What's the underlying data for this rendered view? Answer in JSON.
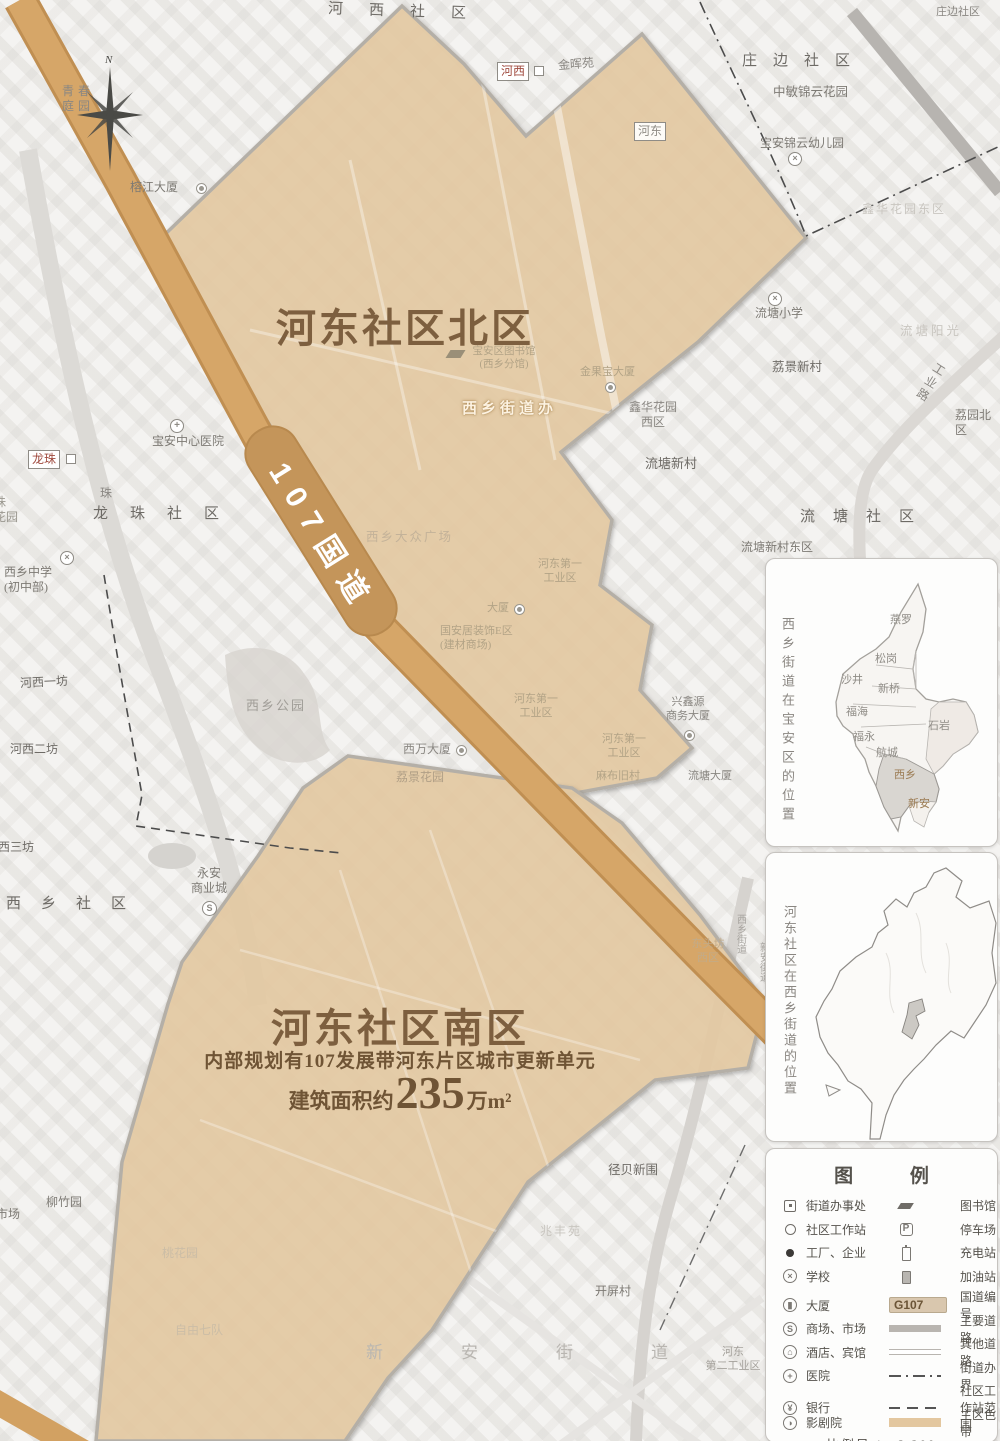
{
  "map": {
    "road_badge": "107国道",
    "compass_n": "N",
    "region_north": {
      "title": "河东社区北区"
    },
    "region_south": {
      "title": "河东社区南区",
      "subtitle": "内部规划有107发展带河东片区城市更新单元",
      "area_prefix": "建筑面积约",
      "area_value": "235",
      "area_suffix": "万m²"
    },
    "colors": {
      "zone_fill": "#e6cba4",
      "road_107": "#d2a162",
      "title_brown": "#7d5f3f"
    },
    "labels": {
      "hexi_shequ": "河西社区",
      "hexi_box": "河西",
      "jinhuiyuan": "金晖苑",
      "zhuangbian": "庄边社区",
      "zhuangbian_corner": "庄边社区",
      "zhongmin": "中敏锦云花园",
      "baoan_kg": "宝安锦云幼儿园",
      "hedong_box": "河东",
      "xinhua_east": "鑫华花园东区",
      "qingchun": "青春\n庭园",
      "rongjiang": "榕江大厦",
      "longzhu_box": "龙珠",
      "hospital": "宝安中心医院",
      "longzhu_shequ": "龙珠社区",
      "zhu_char": "珠",
      "longzhu_garden": "珠\n花园",
      "xixiang_middle": "西乡中学\n(初中部)",
      "hexi_yifang": "河西一坊",
      "hexi_erfang": "河西二坊",
      "hexi_sanfang": "西三坊",
      "xixiang_shequ": "西乡社区",
      "xixiang_park": "西乡公园",
      "yongan": "永安\n商业城",
      "lijing_garden": "荔景花园",
      "ximan_dasha": "西万大厦",
      "jiedaoban": "西乡街道办",
      "library": "宝安区图书馆\n(西乡分馆)",
      "jinguobao": "金果宝大厦",
      "plaza": "西乡大众广场",
      "hedong1a": "河东第一\n工业区",
      "dasha": "大厦",
      "guoanju": "国安居装饰E区\n(建材商场)",
      "hedong1b": "河东第一\n工业区",
      "hedong1c": "河东第一\n工业区",
      "xingxinyuan": "兴鑫源\n商务大厦",
      "mabu": "麻布旧村",
      "liutang_dasha": "流塘大厦",
      "liutang_school": "流塘小学",
      "liutang_sun": "流塘阳光",
      "lijing_xincun": "荔景新村",
      "gongye_road": "工业路",
      "liyuan_north": "荔园北区",
      "liutang_xincun": "流塘新村",
      "liutang_shequ": "流塘社区",
      "liutang_east": "流塘新村东区",
      "xinhua_west": "鑫华花园\n西区",
      "liuzhuyuan": "柳竹园",
      "shichang": "市场",
      "jingbei": "径贝新围",
      "zhaofeng": "兆丰苑",
      "kaiping": "开屏村",
      "xinan_jiedao": "新安街道",
      "hedong2": "河东\n第二工业区",
      "taohuayuan": "桃花园",
      "ziyou": "自由七队",
      "dongtou_west": "东头坊\n西区",
      "xixiang_jiedao_v": "西乡街道",
      "xinan_jiedao_v": "新安街道"
    }
  },
  "insets": {
    "baoan": {
      "title": "西乡街道在宝安区的位置",
      "districts": [
        "燕罗",
        "松岗",
        "沙井",
        "新桥",
        "福海",
        "石岩",
        "福永",
        "航城",
        "西乡",
        "新安"
      ]
    },
    "xixiang": {
      "title": "河东社区在西乡街道的位置"
    }
  },
  "legend": {
    "title": "图 例",
    "left": [
      {
        "label": "街道办事处"
      },
      {
        "label": "社区工作站"
      },
      {
        "label": "工厂、企业"
      },
      {
        "label": "学校"
      },
      {
        "label": "大厦"
      },
      {
        "label": "商场、市场"
      },
      {
        "label": "酒店、宾馆"
      },
      {
        "label": "医院"
      },
      {
        "label": "银行"
      },
      {
        "label": "影剧院"
      }
    ],
    "right": [
      {
        "label": "图书馆"
      },
      {
        "label": "停车场"
      },
      {
        "label": "充电站"
      },
      {
        "label": "加油站"
      },
      {
        "label": "国道编号"
      },
      {
        "label": "主要道路"
      },
      {
        "label": "其他道路"
      },
      {
        "label": "街道办界"
      },
      {
        "label": "社区工作站范围"
      },
      {
        "label": "主区色带"
      }
    ],
    "g107": "G107",
    "scale": "比例尺 1：2 200"
  }
}
